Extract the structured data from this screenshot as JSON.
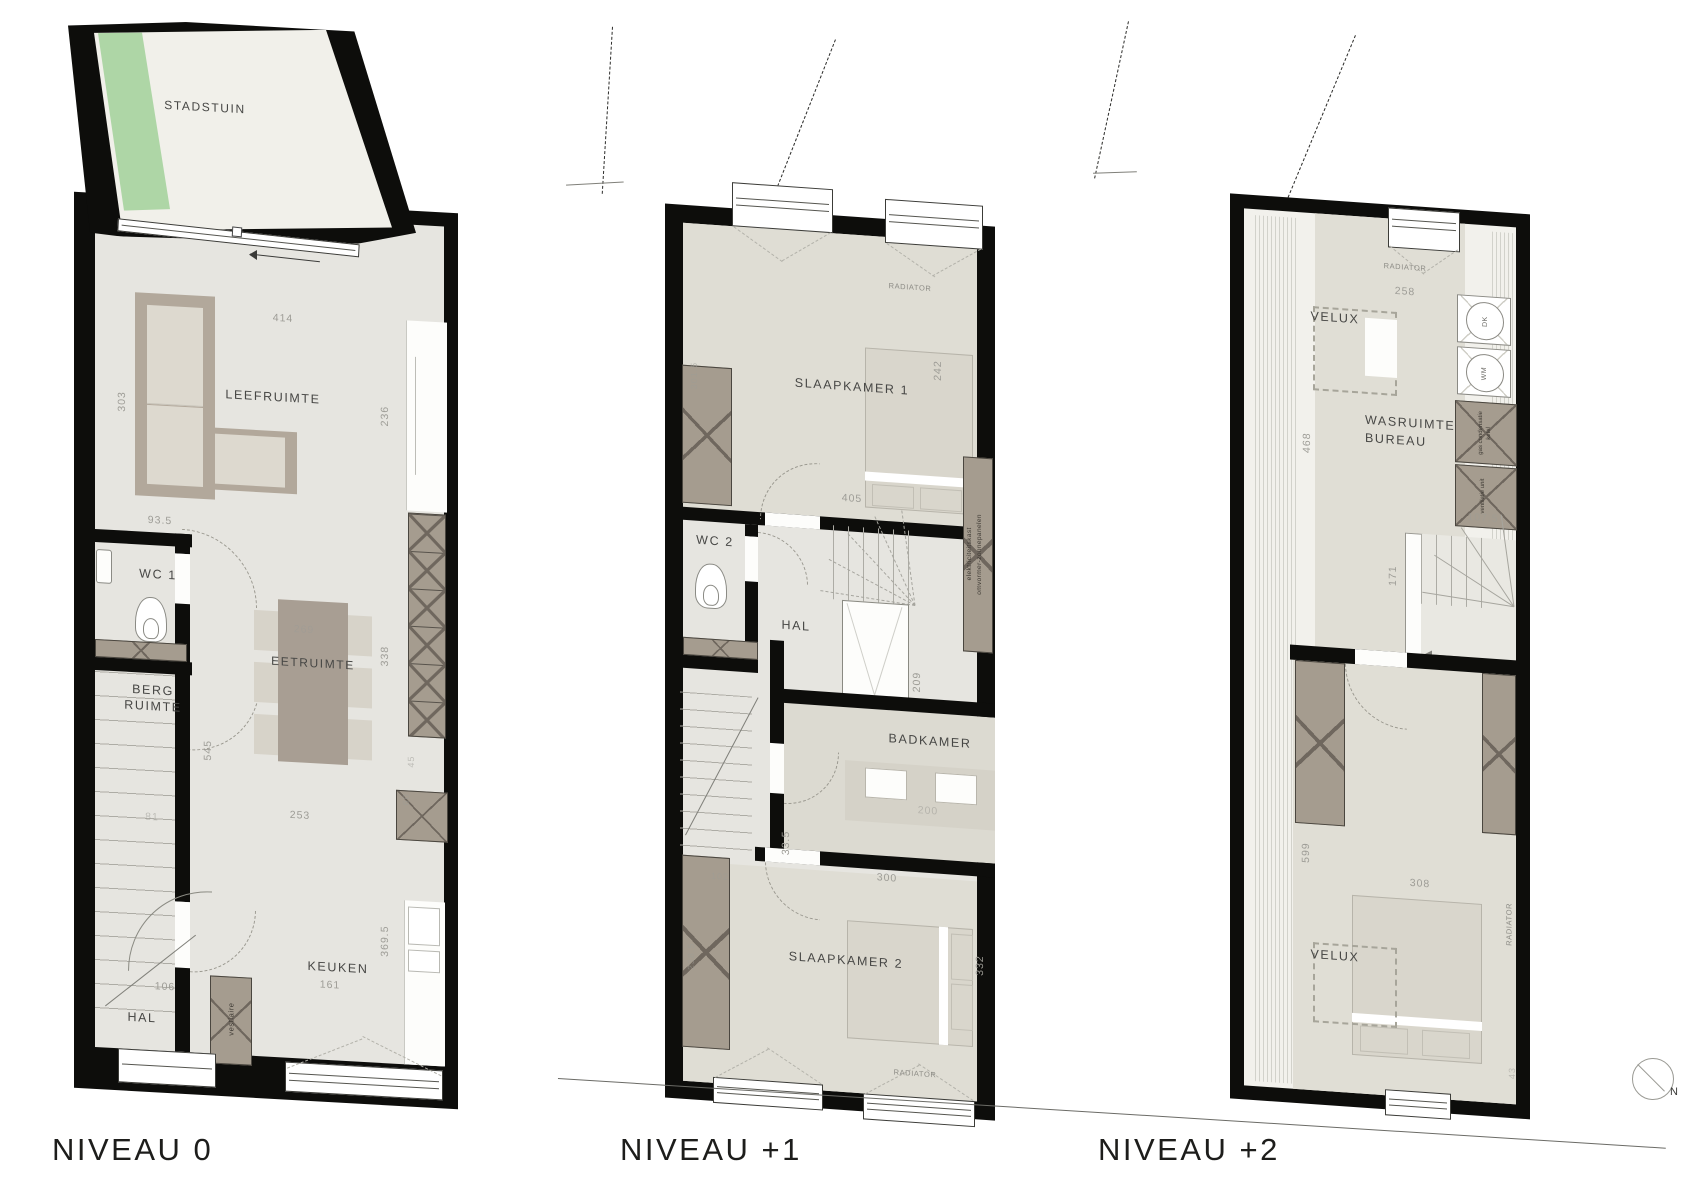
{
  "palette": {
    "walls": "#0d0d0b",
    "floor": "#e6e5e0",
    "garden_green": "#aed6a6",
    "closet": "#a59c8f",
    "furniture": "#d9d6cc"
  },
  "compass": {
    "label": "N"
  },
  "floors": [
    {
      "name": "NIVEAU 0",
      "labels": {
        "stadstuin": "STADSTUIN",
        "leefruimte": "LEEFRUIMTE",
        "wc1": "WC 1",
        "berg_l1": "BERG",
        "berg_l2": "RUIMTE",
        "eetruimte": "EETRUIMTE",
        "keuken": "KEUKEN",
        "hal": "HAL",
        "vestiaire": "vestiaire"
      },
      "dims": {
        "d414": "414",
        "d303": "303",
        "d236": "236",
        "d93_5": "93.5",
        "d269": "269",
        "d338": "338",
        "d545": "545",
        "d81": "81",
        "d253": "253",
        "d45": "45",
        "d60": "60",
        "d106": "106",
        "d161": "161",
        "d369_5": "369.5"
      }
    },
    {
      "name": "NIVEAU +1",
      "labels": {
        "slaapkamer1": "SLAAPKAMER 1",
        "wc2": "WC 2",
        "hal": "HAL",
        "badkamer": "BADKAMER",
        "slaapkamer2": "SLAAPKAMER 2",
        "radiator_top": "RADIATOR",
        "radiator_bottom": "RADIATOR",
        "elektro_1": "elektriciteitskast",
        "elektro_2": "omvormer-zonnepanelen"
      },
      "dims": {
        "d301_5": "301.5",
        "d242": "242",
        "d405": "405",
        "d209": "209",
        "d200": "200",
        "d33_5": "33.5",
        "d300": "300",
        "d102": "102",
        "d238_5": "238.5",
        "d332": "332"
      }
    },
    {
      "name": "NIVEAU +2",
      "labels": {
        "velux_top": "VELUX",
        "velux_bottom": "VELUX",
        "wasruimte_1": "WASRUIMTE/",
        "wasruimte_2": "BUREAU",
        "slaapkamer3": "SLAAPKAMER 3",
        "radiator_top": "RADIATOR",
        "radiator_right": "RADIATOR",
        "dk": "DK",
        "wm": "WM",
        "gas_1": "gas condensatie",
        "gas_2": "ketel",
        "ventilatie": "ventilatie unit"
      },
      "dims": {
        "d258": "258",
        "d468": "468",
        "d107_5": "107.5",
        "d171": "171",
        "d599": "599",
        "d308": "308",
        "d43": "43"
      }
    }
  ]
}
